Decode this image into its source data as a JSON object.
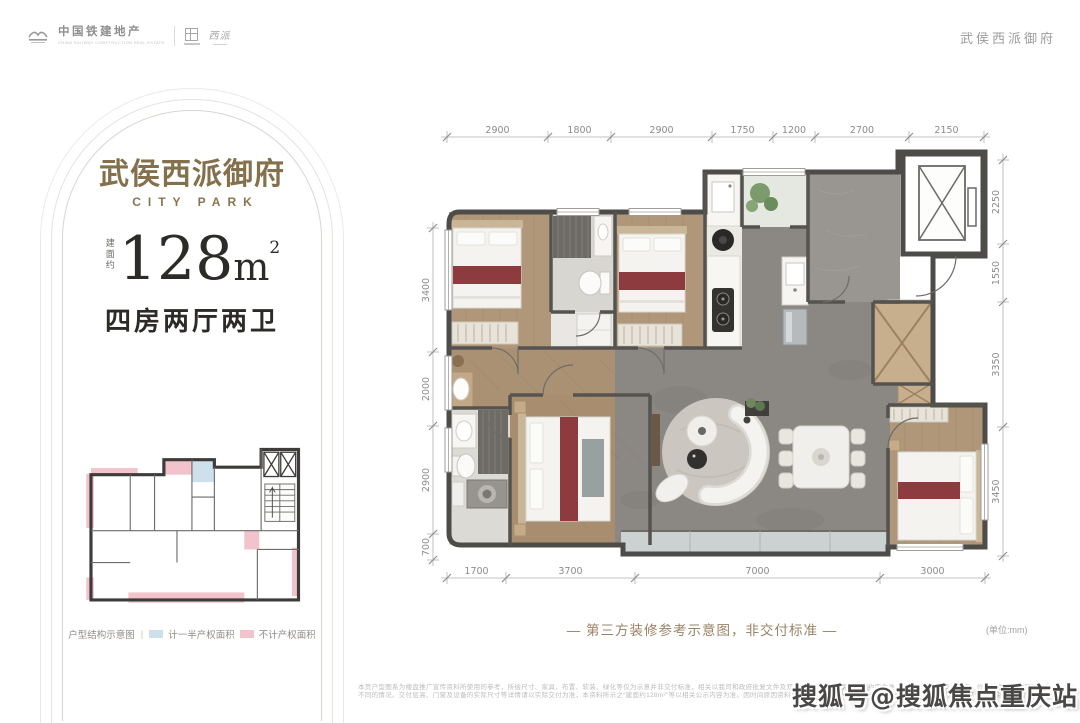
{
  "header": {
    "brand": "中国铁建地产",
    "brand_sub": "CHINA RAILWAY CONSTRUCTION REAL ESTATE",
    "partner_mark": "西派",
    "project_name": "武侯西派御府"
  },
  "card": {
    "title": "武侯西派御府",
    "subtitle": "CITY PARK",
    "area_prefix": "建面约",
    "area_value": "128",
    "area_unit": "m",
    "area_sup": "2",
    "layout": "四房两厅两卫",
    "legend": {
      "label": "户型结构示意图",
      "separator": "|",
      "half_label": "计一半产权面积",
      "half_color": "#cfe0ed",
      "excluded_label": "不计产权面积",
      "excluded_color": "#f2c3ca"
    }
  },
  "plan": {
    "caption": "— 第三方装修参考示意图，非交付标准 —",
    "unit_note": "(单位:mm)",
    "dims": {
      "top": [
        "2900",
        "1800",
        "2900",
        "1750",
        "1200",
        "2700",
        "2150"
      ],
      "right": [
        "2250",
        "1550",
        "3350",
        "3450"
      ],
      "left": [
        "3400",
        "2000",
        "2900",
        "700"
      ],
      "bottom": [
        "1700",
        "3700",
        "7000",
        "3000"
      ]
    },
    "colors": {
      "wall": "#4e4c49",
      "wood": "#b1977a",
      "marble": "#8b8783",
      "accent_red": "#8e3b40",
      "balcony": "#ccd2d2"
    }
  },
  "footer": {
    "disclaimer_line1": "本页户型图系为楼盘推广宣传资料所使用的参考，所绘尺寸、家具、布置、软装、绿化等仅为示意并非交付标准，相关以我司和政府批复文件及双方签署的商品房买卖合同约定为准，相同户型因楼栋、单元、位置等差异，也可能存在",
    "disclaimer_line2": "不同的情况。交付层高、门窗及设备的实际尺寸等详情请以实际交付为准，本资料所示之“建面约128m²”等以相关公示内容为准。因时间原因资料可能变化恕不另行通知，敬请留意最新资料，本户型图作为广告宣传资料参考。",
    "watermark": "搜狐号@搜狐焦点重庆站"
  }
}
